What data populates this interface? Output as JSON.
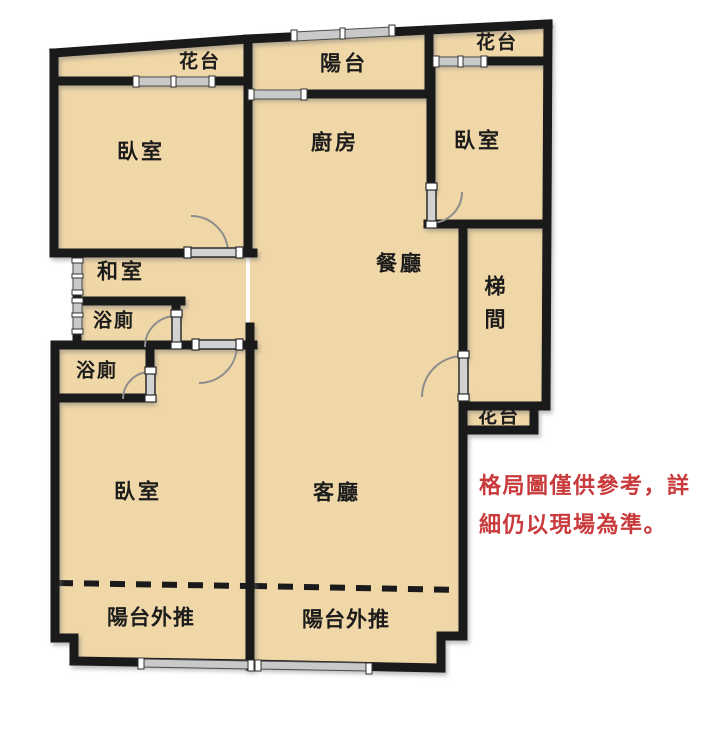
{
  "title": "apartment-floor-plan",
  "colors": {
    "floor": "#f0d7a7",
    "wall": "#1a1a1a",
    "window_fill": "#c9c9c9",
    "door_arc": "#8d8d8d",
    "accent_red": "#c93a3c",
    "background": "#ffffff"
  },
  "rooms": {
    "flower_terrace_top_left": "花台",
    "balcony_top": "陽台",
    "flower_terrace_top_right": "花台",
    "bedroom_top_left": "臥室",
    "kitchen": "廚房",
    "bedroom_top_right": "臥室",
    "japanese_room": "和室",
    "dining_room": "餐廳",
    "stairwell": "梯間",
    "bathroom_upper": "浴廁",
    "bathroom_lower": "浴廁",
    "flower_terrace_right": "花台",
    "bedroom_bottom_left": "臥室",
    "living_room": "客廳",
    "balcony_extension_left": "陽台外推",
    "balcony_extension_right": "陽台外推"
  },
  "disclaimer": "格局圖僅供參考，詳\n細仍以現場為準。"
}
